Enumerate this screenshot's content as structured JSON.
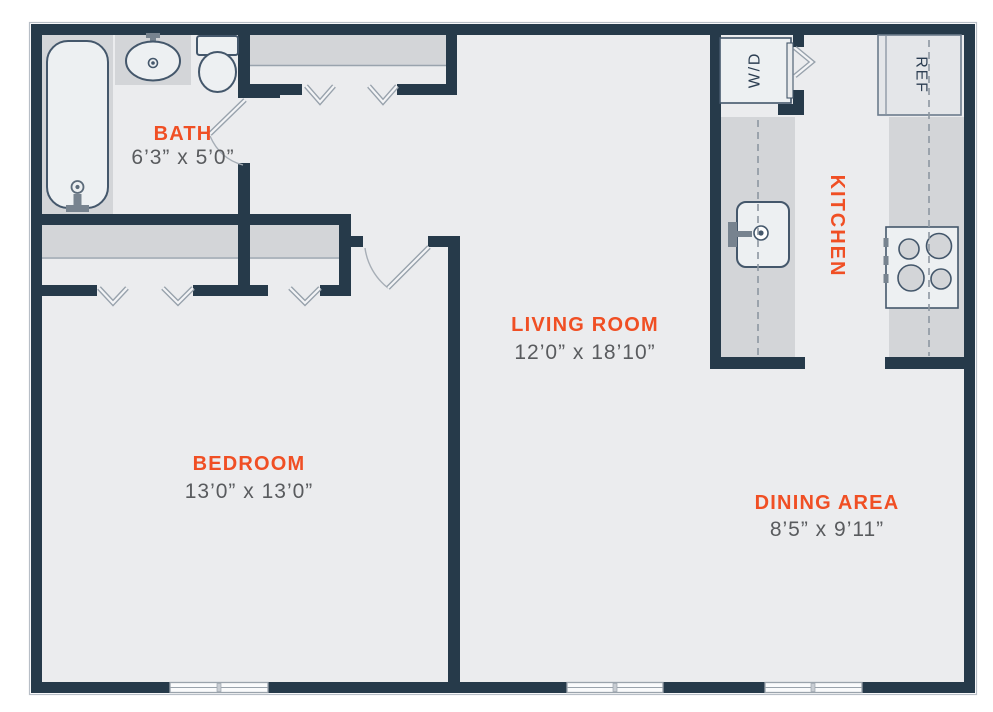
{
  "rooms": {
    "bath": {
      "name": "BATH",
      "dims": "6’3” x 5’0”"
    },
    "living_room": {
      "name": "LIVING ROOM",
      "dims": "12’0” x 18’10”"
    },
    "bedroom": {
      "name": "BEDROOM",
      "dims": "13’0” x 13’0”"
    },
    "dining_area": {
      "name": "DINING AREA",
      "dims": "8’5” x 9’11”"
    },
    "kitchen": {
      "name": "KITCHEN"
    }
  },
  "appliances": {
    "washer_dryer": "W/D",
    "refrigerator": "REF"
  },
  "colors": {
    "accent": "#F04F24",
    "wall": "#263A4A",
    "floor": "#EBECEE",
    "counter": "#D3D5D8",
    "fixture-fill": "#EDF0F2",
    "appliance-fill": "#E4E6E9",
    "dims-text": "#595B5E",
    "label-navy": "#2C3E52",
    "door-line": "#98A2AC",
    "outline-light": "#B7BEC6"
  }
}
